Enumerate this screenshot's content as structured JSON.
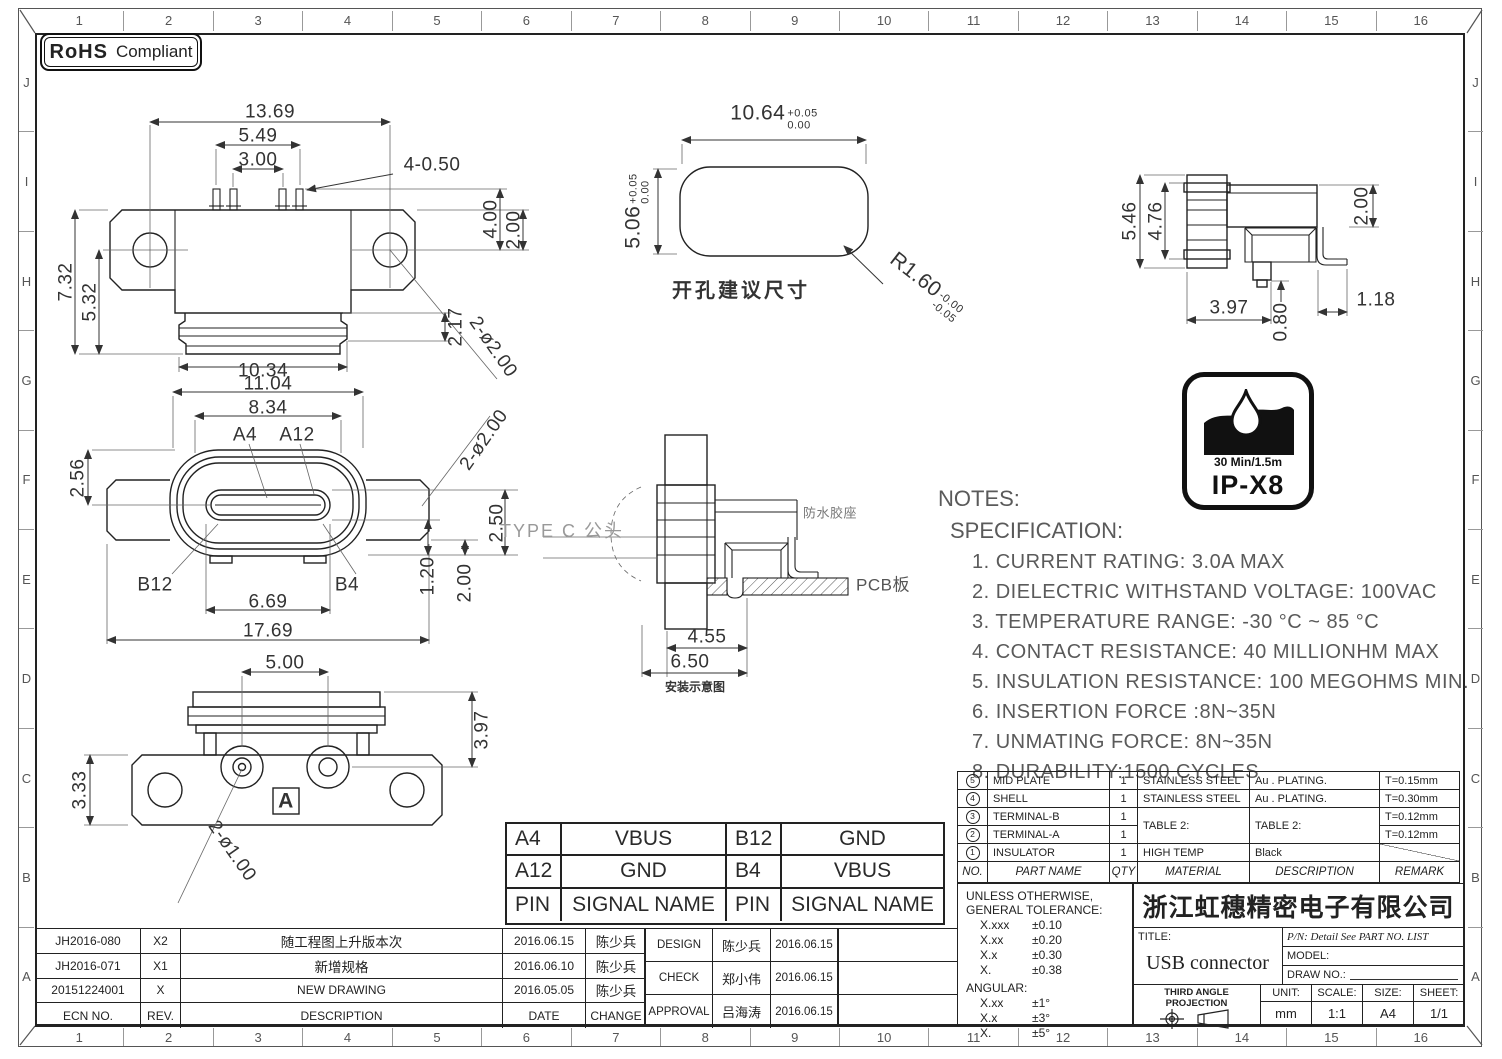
{
  "frame": {
    "cols": [
      "1",
      "2",
      "3",
      "4",
      "5",
      "6",
      "7",
      "8",
      "9",
      "10",
      "11",
      "12",
      "13",
      "14",
      "15",
      "16"
    ],
    "rows": [
      "J",
      "I",
      "H",
      "G",
      "F",
      "E",
      "D",
      "C",
      "B",
      "A"
    ]
  },
  "badge": {
    "bold": "RoHS",
    "rest": "Compliant"
  },
  "front_view": {
    "d1369": "13.69",
    "d549": "5.49",
    "d300": "3.00",
    "d450": "4-0.50",
    "d400": "4.00",
    "d200": "2.00",
    "d732": "7.32",
    "d532": "5.32",
    "d217": "2.17",
    "d1034": "10.34",
    "holes": "2-ø2.00"
  },
  "face_view": {
    "d1104": "11.04",
    "d834": "8.34",
    "a4": "A4",
    "a12": "A12",
    "d256": "2.56",
    "b12": "B12",
    "b4": "B4",
    "d669": "6.69",
    "d120": "1.20",
    "d200": "2.00",
    "d250": "2.50",
    "d1769": "17.69",
    "holes": "2-ø2.00"
  },
  "bottom_view": {
    "d500": "5.00",
    "d397": "3.97",
    "d333": "3.33",
    "holes": "2-ø1.00",
    "section": "A"
  },
  "cutout_view": {
    "width": "10.64",
    "width_tol_hi": "+0.05",
    "width_tol_lo": "0.00",
    "height": "5.06",
    "height_tol_hi": "+0.05",
    "height_tol_lo": "0.00",
    "radius": "R1.60",
    "radius_tol_hi": "-0.00",
    "radius_tol_lo": "-0.05",
    "caption": "开孔建议尺寸"
  },
  "side_view": {
    "d546": "5.46",
    "d476": "4.76",
    "d200": "2.00",
    "d397": "3.97",
    "d080": "0.80",
    "d118": "1.18"
  },
  "mount_view": {
    "plug": "TYPE C 公头",
    "seal": "防水胶座",
    "pcb": "PCB板",
    "d455": "4.55",
    "d650": "6.50",
    "caption": "安装示意图"
  },
  "ip_logo": {
    "rating": "30 Min/1.5m",
    "code": "IP-X8"
  },
  "notes": {
    "title": "NOTES:",
    "subtitle": "SPECIFICATION:",
    "items": [
      "1. CURRENT RATING: 3.0A MAX",
      "2. DIELECTRIC WITHSTAND VOLTAGE: 100VAC",
      "3. TEMPERATURE RANGE: -30 °C ~ 85 °C",
      "4. CONTACT RESISTANCE: 40 MILLIONHM MAX",
      "5. INSULATION RESISTANCE: 100 MEGOHMS MIN.",
      "6. INSERTION FORCE :8N~35N",
      "7. UNMATING FORCE: 8N~35N",
      "8. DURABILITY:1500 CYCLES"
    ]
  },
  "pin_table": {
    "rows": [
      [
        "A4",
        "VBUS",
        "B12",
        "GND"
      ],
      [
        "A12",
        "GND",
        "B4",
        "VBUS"
      ],
      [
        "PIN",
        "SIGNAL NAME",
        "PIN",
        "SIGNAL NAME"
      ]
    ]
  },
  "bom": {
    "headers": {
      "no": "NO.",
      "part": "PART NAME",
      "qty": "QTY",
      "material": "MATERIAL",
      "desc": "DESCRIPTION",
      "remark": "REMARK"
    },
    "rows": [
      {
        "no": "5",
        "part": "MID PLATE",
        "qty": "1",
        "material": "STAINLESS STEEL",
        "desc": "Au . PLATING.",
        "remark": "T=0.15mm"
      },
      {
        "no": "4",
        "part": "SHELL",
        "qty": "1",
        "material": "STAINLESS STEEL",
        "desc": "Au . PLATING.",
        "remark": "T=0.30mm"
      },
      {
        "no": "3",
        "part": "TERMINAL-B",
        "qty": "1",
        "material": "TABLE 2:",
        "desc": "TABLE 2:",
        "remark": "T=0.12mm"
      },
      {
        "no": "2",
        "part": "TERMINAL-A",
        "qty": "1",
        "remark": "T=0.12mm"
      },
      {
        "no": "1",
        "part": "INSULATOR",
        "qty": "1",
        "material": "HIGH TEMP",
        "desc": "Black",
        "remark": ""
      }
    ]
  },
  "tolerance": {
    "line1": "UNLESS OTHERWISE,",
    "line2": "GENERAL TOLERANCE:",
    "rows": [
      [
        "X.xxx",
        "±0.10"
      ],
      [
        "X.xx",
        "±0.20"
      ],
      [
        "X.x",
        "±0.30"
      ],
      [
        "X.",
        "±0.38"
      ]
    ],
    "angular_label": "ANGULAR:",
    "angular_rows": [
      [
        "X.xx",
        "±1°"
      ],
      [
        "X.x",
        "±3°"
      ],
      [
        "X.",
        "±5°"
      ]
    ]
  },
  "title_block": {
    "company": "浙江虹穗精密电子有限公司",
    "title_label": "TITLE:",
    "title": "USB connector",
    "pn": "P/N: Detail See PART NO. LIST",
    "model_label": "MODEL:",
    "draw_label": "DRAW NO.:",
    "projection": "THIRD ANGLE PROJECTION",
    "unit_label": "UNIT:",
    "unit": "mm",
    "scale_label": "SCALE:",
    "scale": "1:1",
    "size_label": "SIZE:",
    "size": "A4",
    "sheet_label": "SHEET:",
    "sheet": "1/1"
  },
  "revisions": {
    "headers": {
      "ecn": "ECN NO.",
      "rev": "REV.",
      "desc": "DESCRIPTION",
      "date": "DATE",
      "change": "CHANGE"
    },
    "rows": [
      {
        "ecn": "JH2016-080",
        "rev": "X2",
        "desc": "随工程图上升版本次",
        "date": "2016.06.15",
        "by": "陈少兵"
      },
      {
        "ecn": "JH2016-071",
        "rev": "X1",
        "desc": "新增规格",
        "date": "2016.06.10",
        "by": "陈少兵"
      },
      {
        "ecn": "20151224001",
        "rev": "X",
        "desc": "NEW DRAWING",
        "date": "2016.05.05",
        "by": "陈少兵"
      }
    ]
  },
  "approvals": {
    "rows": [
      {
        "role": "DESIGN",
        "name": "陈少兵",
        "date": "2016.06.15"
      },
      {
        "role": "CHECK",
        "name": "郑小伟",
        "date": "2016.06.15"
      },
      {
        "role": "APPROVAL",
        "name": "吕海涛",
        "date": "2016.06.15"
      }
    ]
  }
}
